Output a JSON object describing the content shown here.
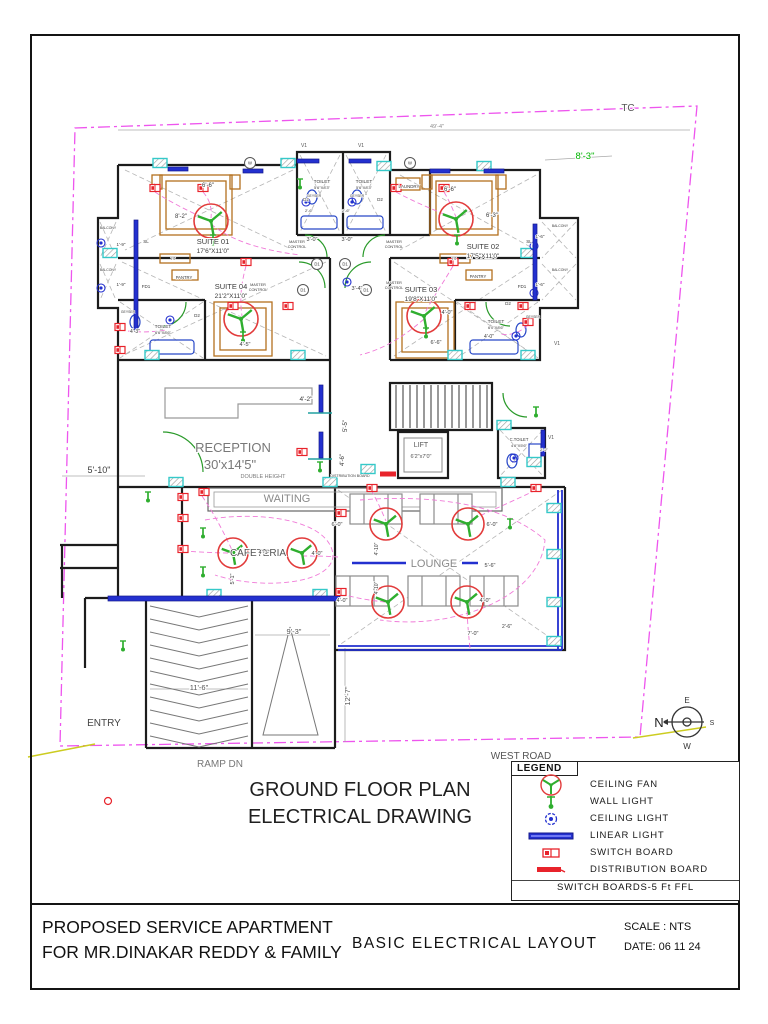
{
  "title_block": {
    "project_line1": "PROPOSED SERVICE APARTMENT",
    "project_line2": "FOR MR.DINAKAR REDDY & FAMILY",
    "drawing_title": "BASIC  ELECTRICAL  LAYOUT",
    "scale": "SCALE : NTS",
    "date": "DATE: 06 11 24"
  },
  "legend": {
    "header": "LEGEND",
    "items": [
      {
        "symbol": "ceiling-fan-icon",
        "label": "CEILING  FAN"
      },
      {
        "symbol": "wall-light-icon",
        "label": "WALL   LIGHT"
      },
      {
        "symbol": "ceiling-light-icon",
        "label": "CEILING  LIGHT"
      },
      {
        "symbol": "linear-light-icon",
        "label": "LINEAR   LIGHT"
      },
      {
        "symbol": "switch-board-icon",
        "label": "SWITCH   BOARD"
      },
      {
        "symbol": "distribution-board-icon",
        "label": "DISTRIBUTION   BOARD"
      }
    ],
    "footer": "SWITCH  BOARDS-5  Ft  FFL"
  },
  "colors": {
    "wall": "#1c1c1c",
    "fan_red": "#e23b3b",
    "green": "#2fae2f",
    "blue": "#2330cf",
    "cyan": "#35c9c9",
    "red": "#e8232b",
    "pink": "#f07ad8",
    "magenta": "#ee55ee",
    "orange": "#b4701e",
    "gray": "#8b8b8b"
  },
  "plan": {
    "labels": [
      {
        "n": "main-title-line1",
        "t": "GROUND FLOOR PLAN",
        "x": 360,
        "y": 796,
        "s": 20,
        "c": "#1f1f1f"
      },
      {
        "n": "main-title-line2",
        "t": "ELECTRICAL DRAWING",
        "x": 360,
        "y": 823,
        "s": 20,
        "c": "#1f1f1f"
      },
      {
        "n": "west-road-label",
        "t": "WEST  ROAD",
        "x": 521,
        "y": 759,
        "s": 10,
        "c": "#555"
      },
      {
        "n": "tc-label",
        "t": "TC",
        "x": 628,
        "y": 111,
        "s": 10,
        "c": "#555"
      },
      {
        "n": "entry-label",
        "t": "ENTRY",
        "x": 104,
        "y": 726,
        "s": 10,
        "c": "#444"
      },
      {
        "n": "ramp-label",
        "t": "RAMP  DN",
        "x": 220,
        "y": 767,
        "s": 10,
        "c": "#777"
      },
      {
        "n": "compass-n",
        "t": "N",
        "x": 659,
        "y": 727,
        "s": 13,
        "c": "#222"
      },
      {
        "n": "compass-e",
        "t": "E",
        "x": 687,
        "y": 703,
        "s": 8,
        "c": "#333"
      },
      {
        "n": "compass-s",
        "t": "S",
        "x": 712,
        "y": 725,
        "s": 7,
        "c": "#333"
      },
      {
        "n": "compass-w",
        "t": "W",
        "x": 687,
        "y": 749,
        "s": 8,
        "c": "#333"
      },
      {
        "t": "SUITE 01",
        "x": 213,
        "y": 244,
        "s": 7.5
      },
      {
        "t": "17'6\"X11'0\"",
        "x": 213,
        "y": 253,
        "s": 6.5
      },
      {
        "t": "SUITE 02",
        "x": 483,
        "y": 249,
        "s": 7.5
      },
      {
        "t": "17'5\"X11'0\"",
        "x": 483,
        "y": 258,
        "s": 6.5
      },
      {
        "t": "SUITE 04",
        "x": 231,
        "y": 289,
        "s": 7.5
      },
      {
        "t": "21'2\"X11'0\"",
        "x": 231,
        "y": 298,
        "s": 6.5
      },
      {
        "t": "SUITE 03",
        "x": 421,
        "y": 292,
        "s": 7.5
      },
      {
        "t": "19'8\"X11'0\"",
        "x": 421,
        "y": 301,
        "s": 6.5
      },
      {
        "t": "RECEPTION",
        "x": 233,
        "y": 452,
        "s": 13,
        "c": "#787878"
      },
      {
        "t": "30'x14'5\"",
        "x": 230,
        "y": 469,
        "s": 13,
        "c": "#787878"
      },
      {
        "t": "DOUBLE  HEIGHT",
        "x": 263,
        "y": 478,
        "s": 5.5,
        "c": "#787878"
      },
      {
        "t": "WAITING",
        "x": 287,
        "y": 502,
        "s": 11,
        "c": "#8a8a8a"
      },
      {
        "t": "CAFETERIA",
        "x": 258,
        "y": 556,
        "s": 10,
        "c": "#555"
      },
      {
        "t": "LOUNGE",
        "x": 434,
        "y": 567,
        "s": 11,
        "c": "#8a8a8a"
      },
      {
        "t": "LIFT",
        "x": 421,
        "y": 447,
        "s": 7,
        "c": "#555"
      },
      {
        "t": "6'2\"x7'0\"",
        "x": 421,
        "y": 458,
        "s": 5.5,
        "c": "#555"
      },
      {
        "t": "C.TOILET",
        "x": 519,
        "y": 441,
        "s": 4.2
      },
      {
        "t": "4'6\"X5'6\"",
        "x": 519,
        "y": 447,
        "s": 4
      },
      {
        "t": "TOILET",
        "x": 322,
        "y": 183,
        "s": 4.8
      },
      {
        "t": "5'6\"X8'3\"",
        "x": 322,
        "y": 189,
        "s": 4
      },
      {
        "t": "TOILET",
        "x": 364,
        "y": 183,
        "s": 4.8
      },
      {
        "t": "5'6\"X8'3\"",
        "x": 364,
        "y": 189,
        "s": 4
      },
      {
        "t": "TOILET",
        "x": 163,
        "y": 328,
        "s": 4.8
      },
      {
        "t": "6'6\"X8'6\"",
        "x": 163,
        "y": 334,
        "s": 4
      },
      {
        "t": "TOILET",
        "x": 496,
        "y": 323,
        "s": 4.8
      },
      {
        "t": "6'0\"X8'6\"",
        "x": 496,
        "y": 329,
        "s": 4
      },
      {
        "t": "GEYSER",
        "x": 314,
        "y": 197,
        "s": 3.4
      },
      {
        "t": "GEYSER",
        "x": 357,
        "y": 197,
        "s": 3.4
      },
      {
        "t": "GEYSER",
        "x": 128,
        "y": 313,
        "s": 3.4
      },
      {
        "t": "GEYSER",
        "x": 533,
        "y": 318,
        "s": 3.4
      },
      {
        "t": "LAUNDRY",
        "x": 409,
        "y": 188,
        "s": 4.4
      },
      {
        "t": "MASTER",
        "x": 297,
        "y": 243,
        "s": 3.8
      },
      {
        "t": "CONTROL",
        "x": 297,
        "y": 248,
        "s": 3.8
      },
      {
        "t": "MASTER",
        "x": 394,
        "y": 243,
        "s": 3.8
      },
      {
        "t": "CONTROL",
        "x": 394,
        "y": 248,
        "s": 3.8
      },
      {
        "t": "MASTER",
        "x": 258,
        "y": 286,
        "s": 3.8
      },
      {
        "t": "CONTROL",
        "x": 258,
        "y": 291,
        "s": 3.8
      },
      {
        "t": "MASTER",
        "x": 394,
        "y": 284,
        "s": 3.8
      },
      {
        "t": "CONTROL",
        "x": 394,
        "y": 289,
        "s": 3.8
      },
      {
        "t": "PANTRY",
        "x": 184,
        "y": 279,
        "s": 4.2
      },
      {
        "t": "PANTRY",
        "x": 478,
        "y": 278,
        "s": 4.2
      },
      {
        "t": "BALCONY",
        "x": 108,
        "y": 229,
        "s": 3.4
      },
      {
        "t": "BALCONY",
        "x": 108,
        "y": 271,
        "s": 3.4
      },
      {
        "t": "BALCONY",
        "x": 560,
        "y": 227,
        "s": 3.4
      },
      {
        "t": "BALCONY",
        "x": 560,
        "y": 271,
        "s": 3.4
      },
      {
        "t": "SL",
        "x": 146,
        "y": 243,
        "s": 4.5
      },
      {
        "t": "SL",
        "x": 529,
        "y": 243,
        "s": 4.5
      },
      {
        "t": "FD1",
        "x": 146,
        "y": 288,
        "s": 4.5
      },
      {
        "t": "FD1",
        "x": 522,
        "y": 288,
        "s": 4.5
      },
      {
        "t": "D2",
        "x": 306,
        "y": 201,
        "s": 4.5
      },
      {
        "t": "D2",
        "x": 380,
        "y": 201,
        "s": 4.5
      },
      {
        "t": "D2",
        "x": 197,
        "y": 317,
        "s": 4.5
      },
      {
        "t": "D2",
        "x": 508,
        "y": 305,
        "s": 4.5
      },
      {
        "t": "V1",
        "x": 304,
        "y": 147,
        "s": 5,
        "c": "#555"
      },
      {
        "t": "V1",
        "x": 361,
        "y": 147,
        "s": 5,
        "c": "#555"
      },
      {
        "t": "V1",
        "x": 551,
        "y": 439,
        "s": 5,
        "c": "#555"
      },
      {
        "t": "V1",
        "x": 557,
        "y": 345,
        "s": 5,
        "c": "#555"
      },
      {
        "t": "TV",
        "x": 173,
        "y": 260,
        "s": 3.8
      },
      {
        "t": "TV",
        "x": 454,
        "y": 260,
        "s": 3.8
      },
      {
        "t": "DISTRIBUTION BOARD",
        "x": 350,
        "y": 477,
        "s": 3.6
      },
      {
        "t": "49'-4\"",
        "x": 437,
        "y": 128,
        "s": 5.5,
        "c": "#8a8a8a"
      },
      {
        "t": "8'-3\"",
        "x": 585,
        "y": 159,
        "s": 9.5,
        "c": "#00b400"
      },
      {
        "t": "6'-6\"",
        "x": 208,
        "y": 187,
        "s": 6
      },
      {
        "t": "8'-2\"",
        "x": 181,
        "y": 218,
        "s": 6
      },
      {
        "t": "6'-6\"",
        "x": 450,
        "y": 191,
        "s": 6
      },
      {
        "t": "6'-3\"",
        "x": 492,
        "y": 217,
        "s": 6
      },
      {
        "t": "3'-0\"",
        "x": 312,
        "y": 241,
        "s": 5.5
      },
      {
        "t": "3'-0\"",
        "x": 347,
        "y": 241,
        "s": 5.5
      },
      {
        "t": "2'-6\"",
        "x": 309,
        "y": 212,
        "s": 4
      },
      {
        "t": "2'-6\"",
        "x": 346,
        "y": 212,
        "s": 4
      },
      {
        "t": "3'-4\"",
        "x": 357,
        "y": 290,
        "s": 5.5
      },
      {
        "t": "1'-9\"",
        "x": 121,
        "y": 246,
        "s": 4.5
      },
      {
        "t": "1'-9\"",
        "x": 121,
        "y": 286,
        "s": 4.5
      },
      {
        "t": "1'-6\"",
        "x": 540,
        "y": 238,
        "s": 4.5
      },
      {
        "t": "1'-6\"",
        "x": 540,
        "y": 286,
        "s": 4.5
      },
      {
        "t": "4'-3\"",
        "x": 135,
        "y": 333,
        "s": 5
      },
      {
        "t": "4'-0\"",
        "x": 447,
        "y": 314,
        "s": 5.5
      },
      {
        "t": "4'-0\"",
        "x": 489,
        "y": 338,
        "s": 5
      },
      {
        "t": "6'-6\"",
        "x": 436,
        "y": 344,
        "s": 5.5
      },
      {
        "t": "4'-5\"",
        "x": 245,
        "y": 346,
        "s": 5.5
      },
      {
        "t": "4'-2\"",
        "x": 306,
        "y": 401,
        "s": 6.5
      },
      {
        "t": "5'-5\"",
        "x": 347,
        "y": 426,
        "s": 6,
        "r": -90
      },
      {
        "t": "4'-6\"",
        "x": 344,
        "y": 460,
        "s": 6,
        "r": -90
      },
      {
        "t": "2'-2\"",
        "x": 544,
        "y": 451,
        "s": 4
      },
      {
        "t": "5'-10\"",
        "x": 99,
        "y": 473,
        "s": 9
      },
      {
        "t": "4'-1\"",
        "x": 264,
        "y": 554,
        "s": 5.5
      },
      {
        "t": "4'-0\"",
        "x": 317,
        "y": 555,
        "s": 5.5
      },
      {
        "t": "5'-1\"",
        "x": 234,
        "y": 579,
        "s": 5.5,
        "r": -90
      },
      {
        "t": "6'-0\"",
        "x": 337,
        "y": 526,
        "s": 5.5
      },
      {
        "t": "6'-0\"",
        "x": 492,
        "y": 526,
        "s": 5.5
      },
      {
        "t": "4'-0\"",
        "x": 342,
        "y": 602,
        "s": 5.5
      },
      {
        "t": "4'-0\"",
        "x": 485,
        "y": 602,
        "s": 5.5
      },
      {
        "t": "4'-10\"",
        "x": 378,
        "y": 549,
        "s": 5,
        "r": -90
      },
      {
        "t": "4'-10\"",
        "x": 378,
        "y": 588,
        "s": 5,
        "r": -90
      },
      {
        "t": "7'-0\"",
        "x": 473,
        "y": 635,
        "s": 5.5
      },
      {
        "t": "2'-6\"",
        "x": 507,
        "y": 628,
        "s": 5
      },
      {
        "t": "5'-6\"",
        "x": 490,
        "y": 567,
        "s": 5.5
      },
      {
        "t": "11'-6\"",
        "x": 199,
        "y": 690,
        "s": 7.5,
        "c": "#555"
      },
      {
        "t": "9'-3\"",
        "x": 294,
        "y": 634,
        "s": 7.5,
        "c": "#555"
      },
      {
        "t": "12'-7\"",
        "x": 350,
        "y": 696,
        "s": 7.5,
        "r": -90,
        "c": "#555"
      }
    ],
    "circle_labels": [
      {
        "t": "W",
        "x": 250,
        "y": 163
      },
      {
        "t": "W",
        "x": 410,
        "y": 163
      },
      {
        "t": "D1",
        "x": 317,
        "y": 264
      },
      {
        "t": "D1",
        "x": 345,
        "y": 264
      },
      {
        "t": "D1",
        "x": 303,
        "y": 290
      },
      {
        "t": "D1",
        "x": 366,
        "y": 290
      }
    ],
    "fans": [
      [
        211,
        221,
        17
      ],
      [
        456,
        219,
        17
      ],
      [
        241,
        319,
        17
      ],
      [
        424,
        316,
        17
      ],
      [
        233,
        553,
        15
      ],
      [
        302,
        553,
        15
      ],
      [
        386,
        524,
        16
      ],
      [
        468,
        524,
        16
      ],
      [
        388,
        602,
        16
      ],
      [
        467,
        602,
        16
      ]
    ],
    "ceiling_lights": [
      [
        101,
        243
      ],
      [
        101,
        288
      ],
      [
        534,
        246
      ],
      [
        534,
        293
      ],
      [
        306,
        202
      ],
      [
        352,
        202
      ],
      [
        170,
        320
      ],
      [
        516,
        336
      ],
      [
        514,
        458
      ],
      [
        347,
        282
      ]
    ],
    "wall_lights": [
      [
        300,
        184
      ],
      [
        213,
        240
      ],
      [
        457,
        240
      ],
      [
        243,
        337
      ],
      [
        426,
        333
      ],
      [
        203,
        533
      ],
      [
        203,
        572
      ],
      [
        510,
        524
      ],
      [
        148,
        497
      ],
      [
        123,
        646
      ],
      [
        536,
        412
      ],
      [
        320,
        467
      ]
    ],
    "linear_lights": [
      [
        168,
        167,
        20,
        4
      ],
      [
        243,
        169,
        20,
        4
      ],
      [
        297,
        159,
        22,
        4
      ],
      [
        349,
        159,
        22,
        4
      ],
      [
        430,
        169,
        20,
        4
      ],
      [
        484,
        169,
        20,
        4
      ],
      [
        319,
        385,
        4,
        27
      ],
      [
        319,
        432,
        4,
        26
      ],
      [
        541,
        430,
        4,
        26
      ],
      [
        134,
        220,
        4,
        110
      ],
      [
        533,
        224,
        4,
        76
      ],
      [
        108,
        596,
        232,
        5
      ]
    ],
    "switch_boards": [
      [
        155,
        188
      ],
      [
        203,
        188
      ],
      [
        396,
        188
      ],
      [
        444,
        188
      ],
      [
        120,
        327
      ],
      [
        120,
        350
      ],
      [
        246,
        262
      ],
      [
        453,
        262
      ],
      [
        233,
        306
      ],
      [
        288,
        306
      ],
      [
        470,
        306
      ],
      [
        523,
        306
      ],
      [
        183,
        497
      ],
      [
        183,
        518
      ],
      [
        183,
        549
      ],
      [
        204,
        492
      ],
      [
        341,
        513
      ],
      [
        341,
        592
      ],
      [
        372,
        488
      ],
      [
        536,
        488
      ],
      [
        302,
        452
      ],
      [
        528,
        322
      ]
    ],
    "distribution_boards": [
      [
        388,
        474
      ]
    ],
    "columns": [
      [
        160,
        163
      ],
      [
        288,
        163
      ],
      [
        384,
        166
      ],
      [
        484,
        166
      ],
      [
        110,
        253
      ],
      [
        528,
        253
      ],
      [
        152,
        355
      ],
      [
        298,
        355
      ],
      [
        455,
        355
      ],
      [
        528,
        355
      ],
      [
        176,
        482
      ],
      [
        330,
        482
      ],
      [
        508,
        482
      ],
      [
        554,
        508
      ],
      [
        554,
        554
      ],
      [
        554,
        602
      ],
      [
        554,
        641
      ],
      [
        214,
        594
      ],
      [
        320,
        594
      ],
      [
        504,
        425
      ],
      [
        534,
        462
      ],
      [
        368,
        469
      ]
    ],
    "wires": [
      "M155 192 C175 205 195 214 208 220",
      "M203 192 C210 200 212 208 211 218",
      "M444 192 C450 202 453 210 456 217",
      "M396 192 C420 205 440 212 453 218",
      "M246 266 C240 288 240 302 242 316",
      "M453 266 C440 288 430 302 425 313",
      "M120 330 C140 333 152 332 166 330",
      "M528 325 C520 332 512 336 500 334",
      "M202 496 C215 515 225 535 232 550",
      "M183 551 C200 552 215 553 230 553",
      "M302 556 C315 556 325 556 338 557",
      "M371 490 C378 502 382 512 386 521",
      "M536 490 C505 505 480 515 470 521",
      "M341 594 C360 599 375 601 385 602",
      "M470 648 C468 630 467 615 467 605",
      "M211 224 C230 240 260 250 300 255",
      "M424 319 C400 340 380 350 360 355",
      "M205 520 C260 510 330 520 333 555 C333 585 260 590 215 575",
      "M360 500 C420 495 500 500 545 540 C540 600 450 630 380 620"
    ]
  }
}
